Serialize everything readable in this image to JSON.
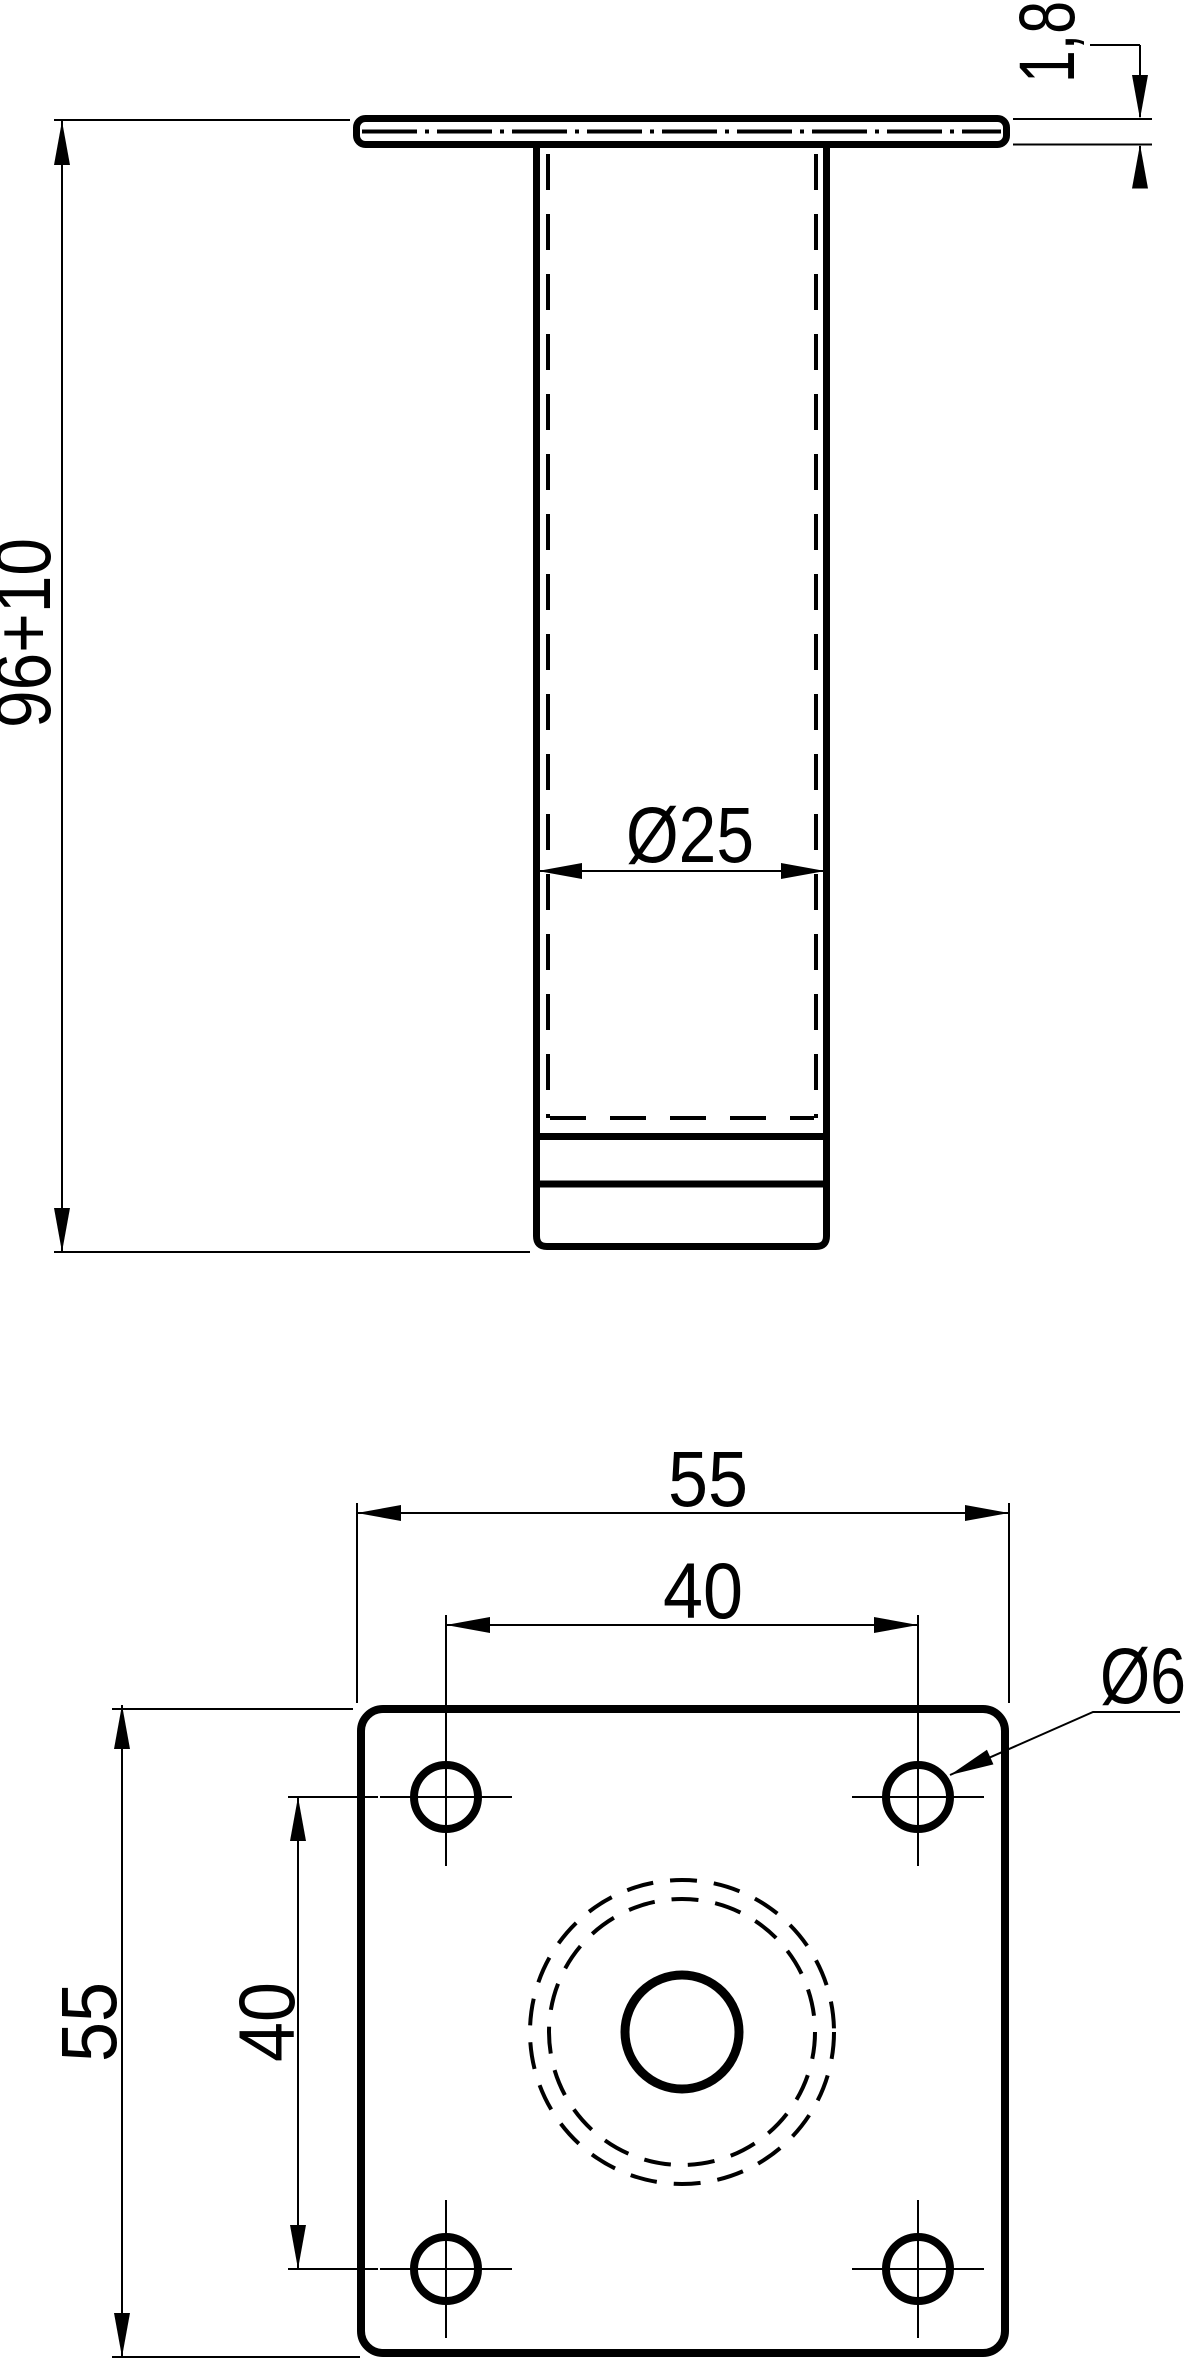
{
  "page": {
    "background_color": "#ffffff",
    "line_color": "#000000",
    "description": "Technical drawing of adjustable furniture leg with mounting plate, front view and bottom plan view"
  },
  "drawing": {
    "views": {
      "front": {
        "dims": {
          "height": "96+10",
          "plate_thickness": "1,8",
          "tube_diameter": "Ø25"
        }
      },
      "plan": {
        "dims": {
          "plate_width": "55",
          "plate_depth": "55",
          "hole_pitch_x": "40",
          "hole_pitch_y": "40",
          "hole_diameter": "Ø6"
        }
      }
    }
  }
}
